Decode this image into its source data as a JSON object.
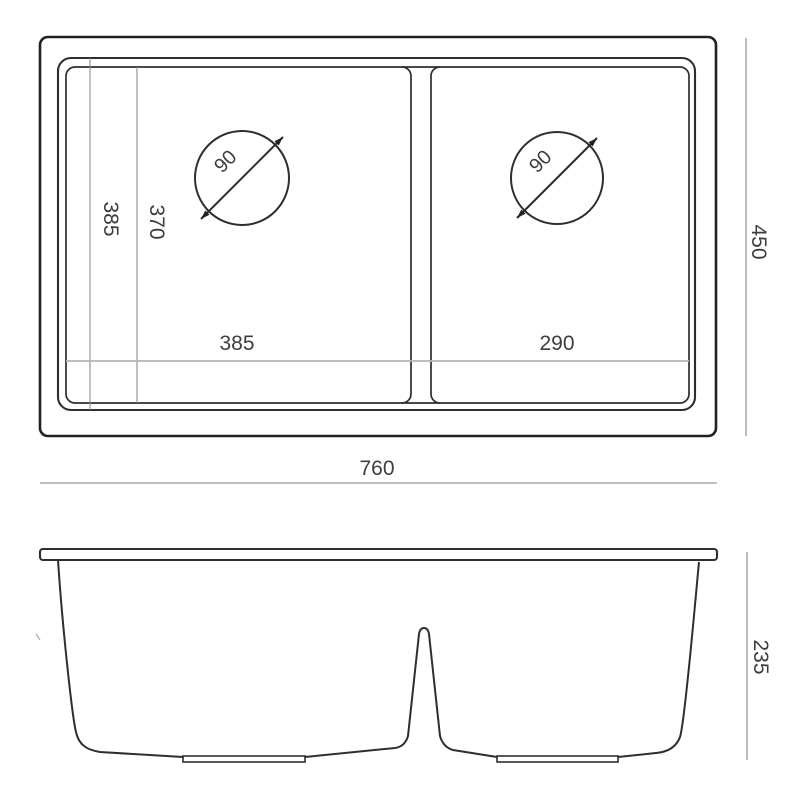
{
  "drawing_type": "sink-dimension-drawing",
  "labels": {
    "overall_width": "760",
    "overall_depth": "450",
    "left_bowl_width": "385",
    "right_bowl_width": "290",
    "left_bowl_length_outer": "385",
    "left_bowl_length_inner": "370",
    "drain_left_diameter": "90",
    "drain_right_diameter": "90",
    "front_height": "235"
  },
  "colors": {
    "outline": "#212121",
    "secondary_line": "#2e2e2e",
    "dimension_line": "#b5b5b5",
    "extension_line": "#8c8c8c",
    "label_text": "#3d3d3d",
    "background": "#ffffff"
  }
}
